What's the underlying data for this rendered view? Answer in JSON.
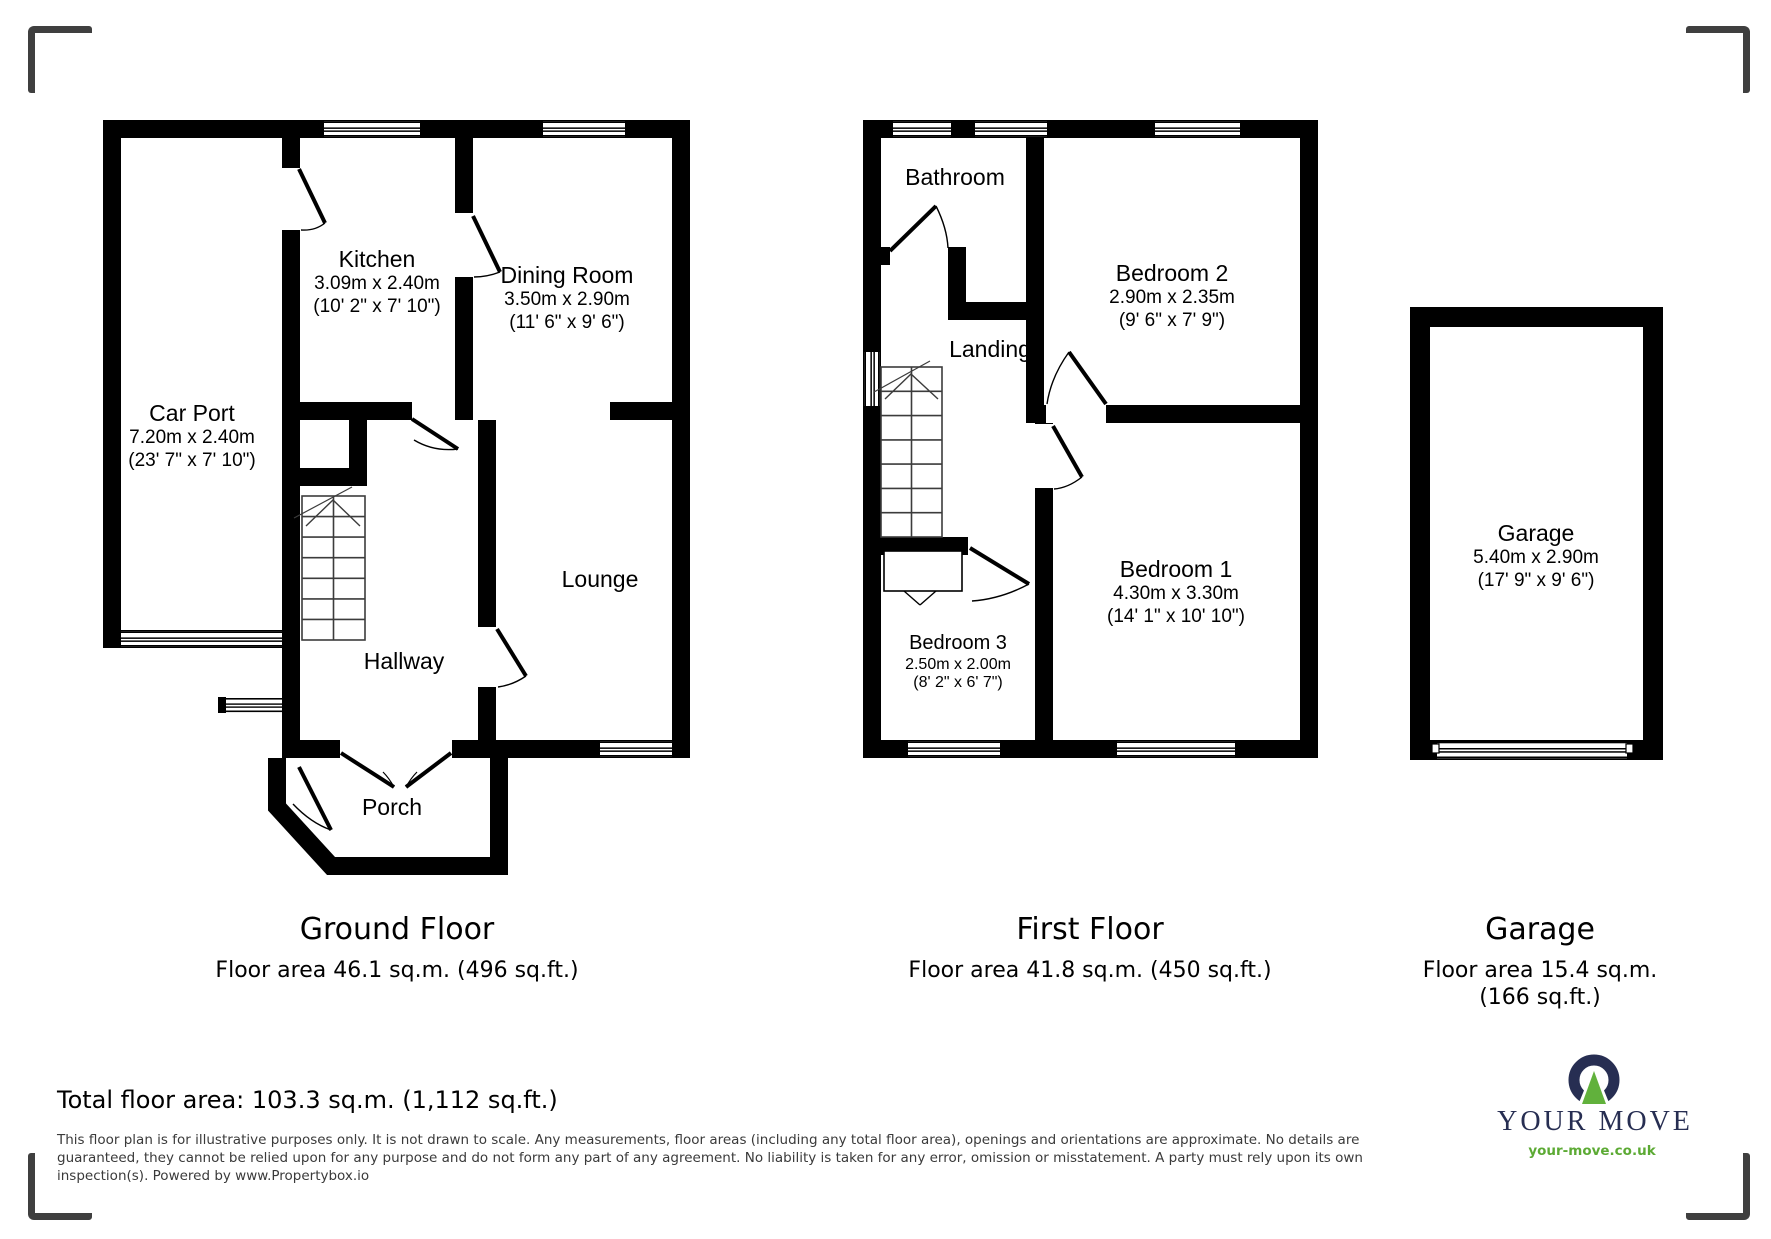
{
  "colors": {
    "wall": "#000000",
    "brand_navy": "#272e52",
    "brand_green": "#61b13c",
    "bracket_gray": "#3f3f3f"
  },
  "ground_floor": {
    "caption": "Ground Floor",
    "area_line": "Floor area 46.1 sq.m. (496 sq.ft.)",
    "rooms": {
      "car_port": {
        "name": "Car Port",
        "dims_m": "7.20m x 2.40m",
        "dims_ft": "(23' 7\" x 7' 10\")"
      },
      "kitchen": {
        "name": "Kitchen",
        "dims_m": "3.09m x 2.40m",
        "dims_ft": "(10' 2\" x 7' 10\")"
      },
      "dining": {
        "name": "Dining Room",
        "dims_m": "3.50m x 2.90m",
        "dims_ft": "(11' 6\" x 9' 6\")"
      },
      "lounge": {
        "name": "Lounge"
      },
      "hallway": {
        "name": "Hallway"
      },
      "porch": {
        "name": "Porch"
      }
    }
  },
  "first_floor": {
    "caption": "First Floor",
    "area_line": "Floor area 41.8 sq.m. (450 sq.ft.)",
    "rooms": {
      "bathroom": {
        "name": "Bathroom"
      },
      "landing": {
        "name": "Landing"
      },
      "bedroom2": {
        "name": "Bedroom 2",
        "dims_m": "2.90m x 2.35m",
        "dims_ft": "(9' 6\" x 7' 9\")"
      },
      "bedroom1": {
        "name": "Bedroom 1",
        "dims_m": "4.30m x 3.30m",
        "dims_ft": "(14' 1\" x 10' 10\")"
      },
      "bedroom3": {
        "name": "Bedroom 3",
        "dims_m": "2.50m x 2.00m",
        "dims_ft": "(8' 2\" x 6' 7\")"
      }
    }
  },
  "garage": {
    "caption": "Garage",
    "area_line1": "Floor area 15.4 sq.m.",
    "area_line2": "(166 sq.ft.)",
    "room": {
      "name": "Garage",
      "dims_m": "5.40m x 2.90m",
      "dims_ft": "(17' 9\" x 9' 6\")"
    }
  },
  "summary": {
    "total": "Total floor area: 103.3 sq.m. (1,112 sq.ft.)"
  },
  "disclaimer": {
    "lines": [
      "This floor plan is for illustrative purposes only. It is not drawn to scale. Any measurements, floor areas (including any total floor area), openings and orientations are approximate. No details are",
      "guaranteed, they cannot be relied upon for any purpose and do not form any part of any agreement. No liability is taken for any error, omission or misstatement. A party must rely upon its own",
      "inspection(s). Powered by www.Propertybox.io"
    ]
  },
  "logo": {
    "brand": "YOUR MOVE",
    "url": "your-move.co.uk"
  }
}
